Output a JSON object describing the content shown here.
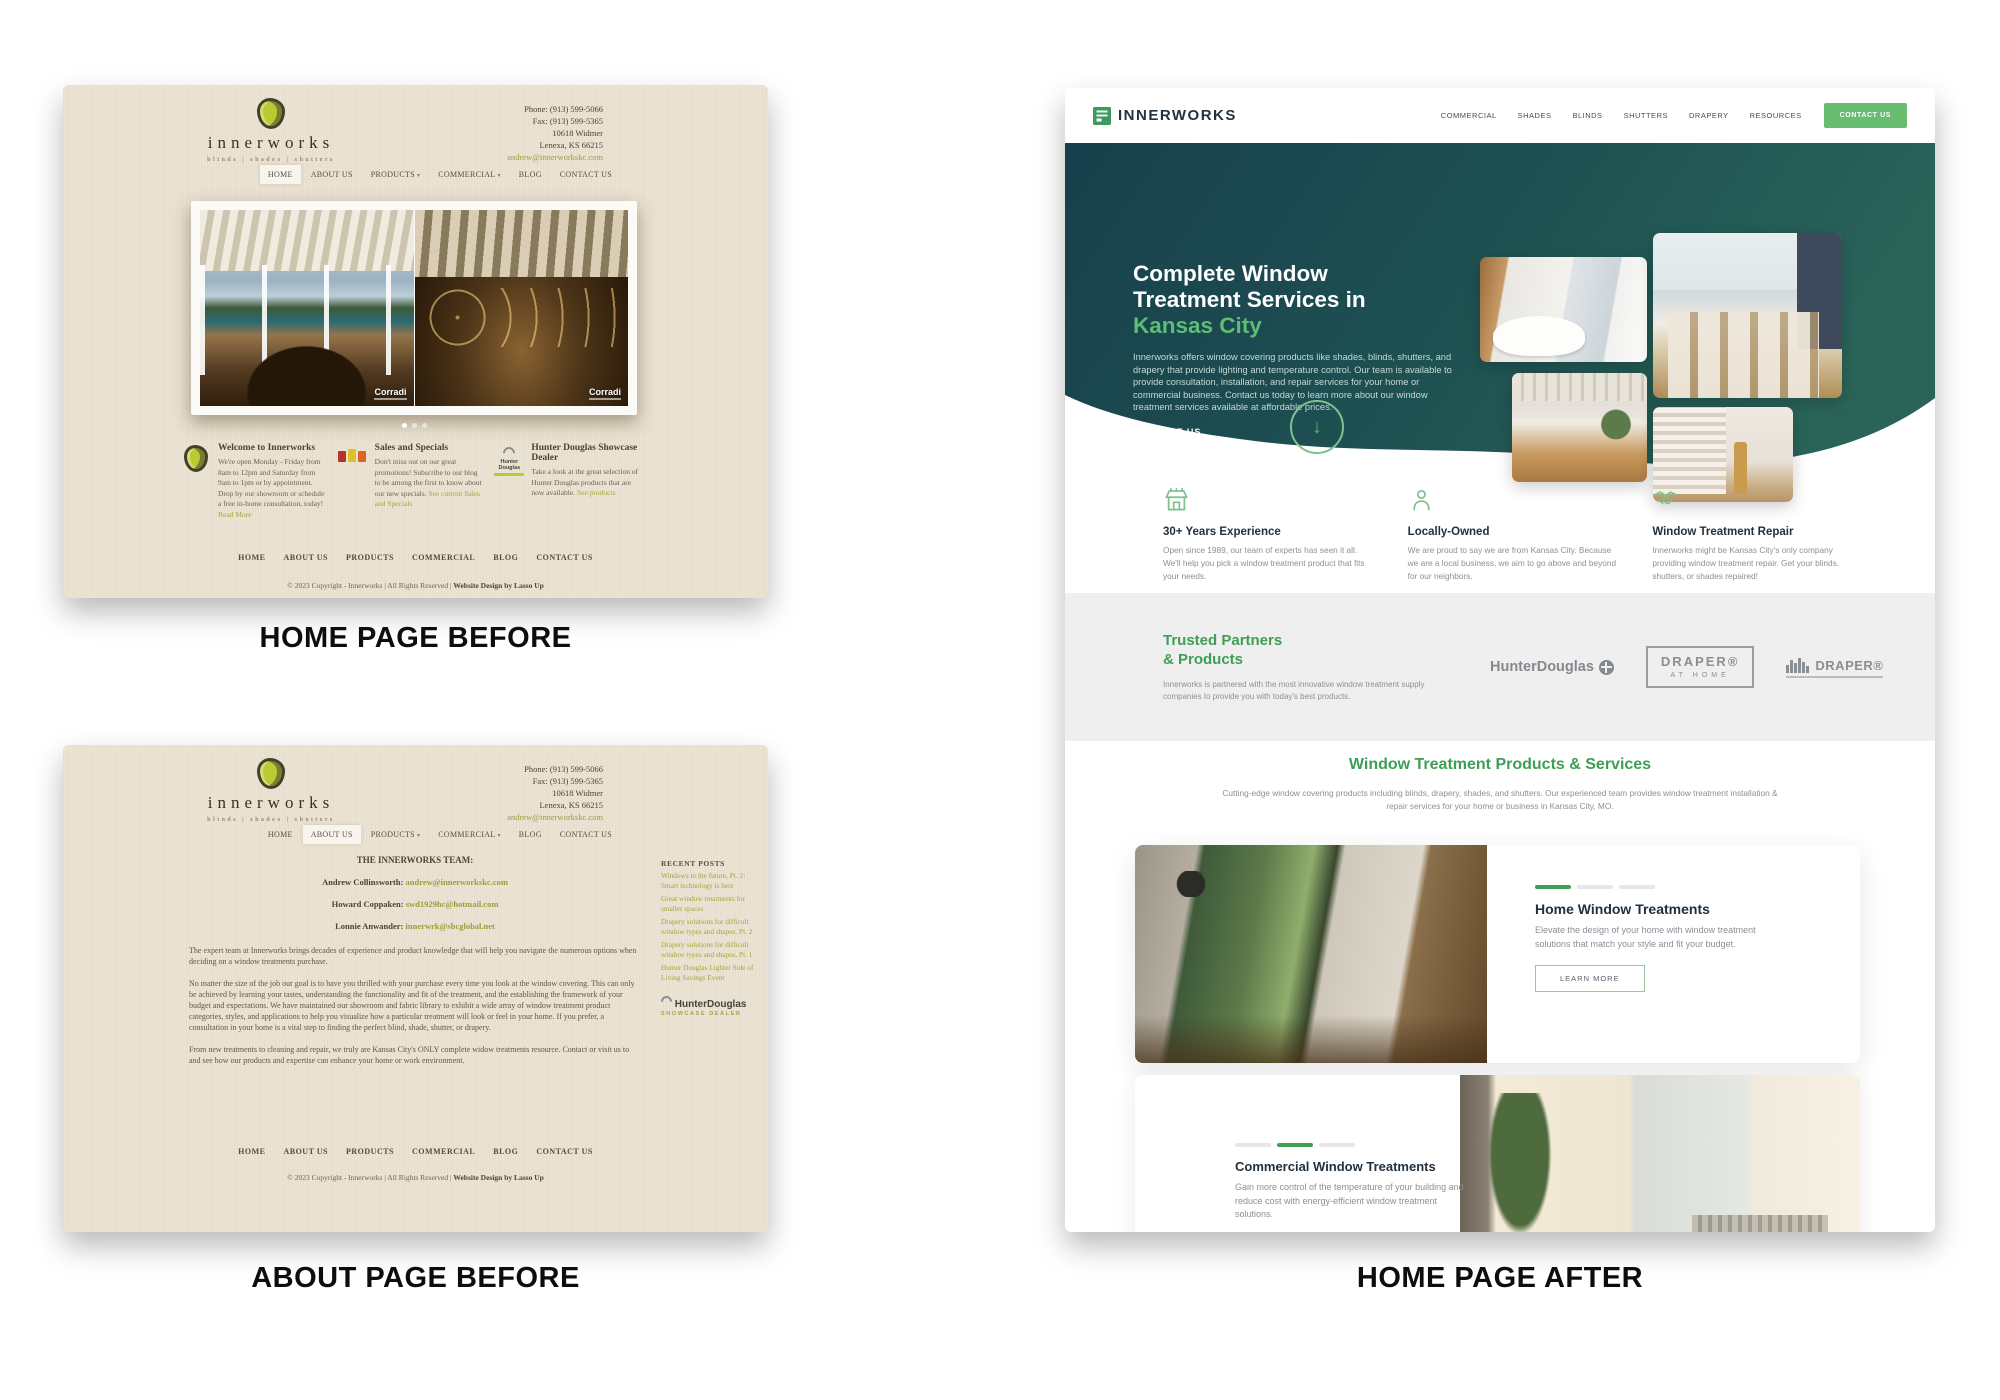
{
  "captions": {
    "home_before": "HOME PAGE BEFORE",
    "about_before": "ABOUT PAGE BEFORE",
    "home_after": "HOME PAGE AFTER"
  },
  "before": {
    "logo": {
      "word": "innerworks",
      "tagline": "blinds | shades | shutters"
    },
    "contact": {
      "phone": "Phone: (913) 599-5066",
      "fax": "Fax: (913) 599-5365",
      "address1": "10618 Widmer",
      "address2": "Lenexa, KS 66215",
      "email": "andrew@innerworkskc.com"
    },
    "nav": [
      {
        "label": "HOME"
      },
      {
        "label": "ABOUT US"
      },
      {
        "label": "PRODUCTS"
      },
      {
        "label": "COMMERCIAL"
      },
      {
        "label": "BLOG"
      },
      {
        "label": "CONTACT US"
      }
    ],
    "slider_brand": "Corradi",
    "features": [
      {
        "title": "Welcome to Innerworks",
        "text": "We're open Monday - Friday from 8am to 12pm and Saturday from 9am to 1pm or by appointment. Drop by our showroom or schedule a free in-home consultation, today!",
        "link": "Read More"
      },
      {
        "title": "Sales and Specials",
        "text": "Don't miss out on our great promotions! Subscribe to our blog to be among the first to know about our new specials.",
        "link": "See current Sales and Specials"
      },
      {
        "title": "Hunter Douglas Showcase Dealer",
        "text": "Take a look at the great selection of Hunter Douglas products that are now available.",
        "link": "See products"
      }
    ],
    "hd_mini": {
      "line1": "Hunter",
      "line2": "Douglas"
    },
    "footer_nav": [
      "HOME",
      "ABOUT US",
      "PRODUCTS",
      "COMMERCIAL",
      "BLOG",
      "CONTACT US"
    ],
    "copyright": "© 2023 Copyright - Innerworks | All Rights Reserved | ",
    "copyright_link": "Website Design by Lasso Up"
  },
  "about": {
    "team_heading": "THE INNERWORKS TEAM:",
    "team": [
      {
        "name": "Andrew Collinsworth:",
        "email": "andrew@innerworkskc.com"
      },
      {
        "name": "Howard Coppaken:",
        "email": "swd1929hc@hotmail.com"
      },
      {
        "name": "Lonnie Anwander:",
        "email": "innerwrk@sbcglobal.net"
      }
    ],
    "paragraphs": [
      "The expert team at Innerworks brings decades of experience and product knowledge that will help you navigate the numerous options when deciding on a window treatments purchase.",
      "No matter the size of the job our goal is to have you thrilled with your purchase every time you look at the window covering.  This can only be achieved by learning your tastes, understanding the functionality and fit of the treatment, and the establishing the framework of your budget and expectations.  We have maintained our showroom and fabric library to exhibit a wide array of window treatment product categories, styles, and applications to help you visualize how a particular treatment will look or feel in your home. If you prefer, a consultation in your home is a vital step to finding the perfect blind, shade, shutter, or drapery.",
      "From new treatments to cleaning and repair, we truly are Kansas City's ONLY complete widow treatments resource.  Contact or visit us to and see how our products and expertise can enhance your home or work environment."
    ],
    "recent_posts_heading": "RECENT POSTS",
    "recent_posts": [
      "Windows to the future, Pt. 2: Smart technology is here",
      "Great window treatments for smaller spaces",
      "Drapery solutions for difficult window types and shapes, Pt. 2",
      "Drapery solutions for difficult window types and shapes, Pt. 1",
      "Hunter Douglas Lighter Side of Living Savings Event"
    ],
    "hd_badge": {
      "brand": "HunterDouglas",
      "sub": "SHOWCASE DEALER"
    }
  },
  "after": {
    "logo": "INNERWORKS",
    "nav": [
      "COMMERCIAL",
      "SHADES",
      "BLINDS",
      "SHUTTERS",
      "DRAPERY",
      "RESOURCES"
    ],
    "contact_button": "CONTACT US",
    "hero": {
      "title1": "Complete Window",
      "title2": "Treatment Services in",
      "accent": "Kansas City",
      "body": "Innerworks offers window covering products like shades, blinds, shutters, and drapery that provide lighting and temperature control. Our team is available to provide consultation, installation, and repair services for your home or commercial business. Contact us today to learn more about our window treatment services available at affordable prices.",
      "cta": "CONTACT US"
    },
    "features": [
      {
        "title": "30+ Years Experience",
        "text": "Open since 1989, our team of experts has seen it all. We'll help you pick a window treatment product that fits your needs."
      },
      {
        "title": "Locally-Owned",
        "text": "We are proud to say we are from Kansas City. Because we are a local business, we aim to go above and beyond for our neighbors."
      },
      {
        "title": "Window Treatment Repair",
        "text": "Innerworks might be Kansas City's only company providing window treatment repair. Get your blinds, shutters, or shades repaired!"
      }
    ],
    "partners": {
      "title1": "Trusted Partners",
      "title2": "& Products",
      "text": "Innerworks is partnered with the most innovative window treatment supply companies to provide you with today's best products.",
      "hunter_douglas": "HunterDouglas",
      "draper_home_line1": "DRAPER®",
      "draper_home_line2": "AT HOME",
      "draper": "DRAPER®"
    },
    "products": {
      "title": "Window Treatment Products & Services",
      "subtitle": "Cutting-edge window covering products including blinds, drapery, shades, and shutters. Our experienced team provides window treatment installation & repair services for your home or business in Kansas City, MO.",
      "card1": {
        "title": "Home Window Treatments",
        "text": "Elevate the design of your home with window treatment solutions that match your style and fit your budget.",
        "button": "LEARN MORE"
      },
      "card2": {
        "title": "Commercial Window Treatments",
        "text": "Gain more control of the temperature of your building and reduce cost with energy-efficient window treatment solutions."
      }
    }
  },
  "colors": {
    "beige": "#eae2d2",
    "olive_link": "#a3a83b",
    "hero_teal_dark": "#183f4c",
    "hero_teal": "#2a6459",
    "green_accent": "#5dbd74",
    "button_green": "#68bd70",
    "section_green": "#3f9e55"
  }
}
